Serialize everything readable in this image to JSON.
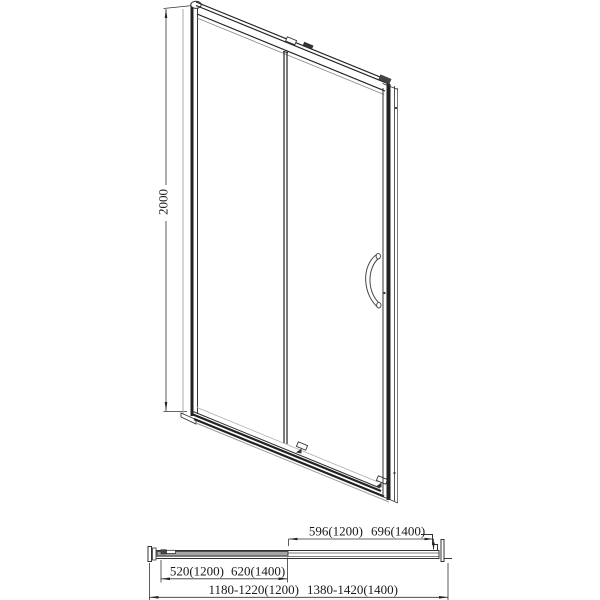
{
  "figure": {
    "line_color": "#222222",
    "light_line_color": "#9a9a9a",
    "panel_fill_color": "#a6a6a6",
    "background_color": "#ffffff"
  },
  "side_view": {
    "height_dim": "2000"
  },
  "plan_view": {
    "opening_dim": {
      "v1200": "596(1200)",
      "v1400": "696(1400)"
    },
    "panel_dim": {
      "v1200": "520(1200)",
      "v1400": "620(1400)"
    },
    "overall_dim": {
      "v1200": "1180-1220(1200)",
      "v1400": "1380-1420(1400)"
    }
  }
}
